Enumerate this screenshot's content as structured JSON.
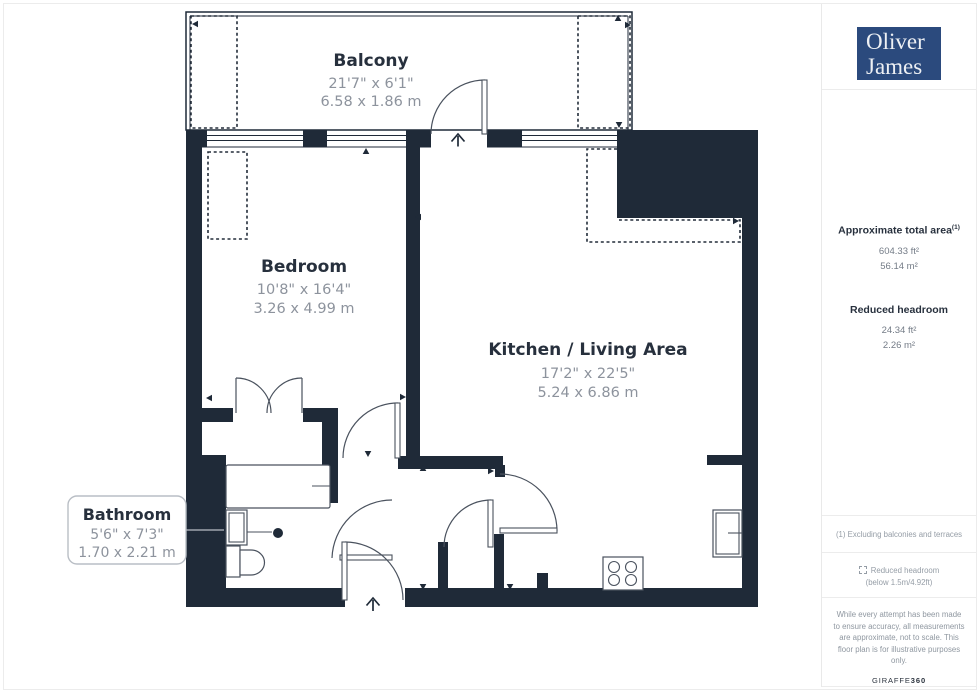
{
  "branding": {
    "agency_line1": "Oliver",
    "agency_line2": "James",
    "provider_name": "GIRAFFE",
    "provider_suffix": "360"
  },
  "sidebar": {
    "total_area": {
      "label": "Approximate total area",
      "footnote_marker": "(1)",
      "value_imperial": "604.33 ft²",
      "value_metric": "56.14 m²"
    },
    "reduced_headroom": {
      "label": "Reduced headroom",
      "value_imperial": "24.34 ft²",
      "value_metric": "2.26 m²"
    },
    "footnote": "(1) Excluding balconies and terraces",
    "legend": {
      "label": "Reduced headroom",
      "detail": "(below 1.5m/4.92ft)"
    },
    "disclaimer": "While every attempt has been made to ensure accuracy, all measurements are approximate, not to scale. This floor plan is for illustrative purposes only."
  },
  "floorplan": {
    "rooms": [
      {
        "name": "Balcony",
        "imperial": "21'7\" x 6'1\"",
        "metric": "6.58 x 1.86 m"
      },
      {
        "name": "Bedroom",
        "imperial": "10'8\" x 16'4\"",
        "metric": "3.26 x 4.99 m"
      },
      {
        "name": "Kitchen / Living Area",
        "imperial": "17'2\" x 22'5\"",
        "metric": "5.24 x 6.86 m"
      },
      {
        "name": "Bathroom",
        "imperial": "5'6\" x 7'3\"",
        "metric": "1.70 x 2.21 m"
      }
    ],
    "colors": {
      "wall": "#1f2a38",
      "logo_blue": "#2b4a7d",
      "dimension_text": "#8d939d"
    }
  }
}
